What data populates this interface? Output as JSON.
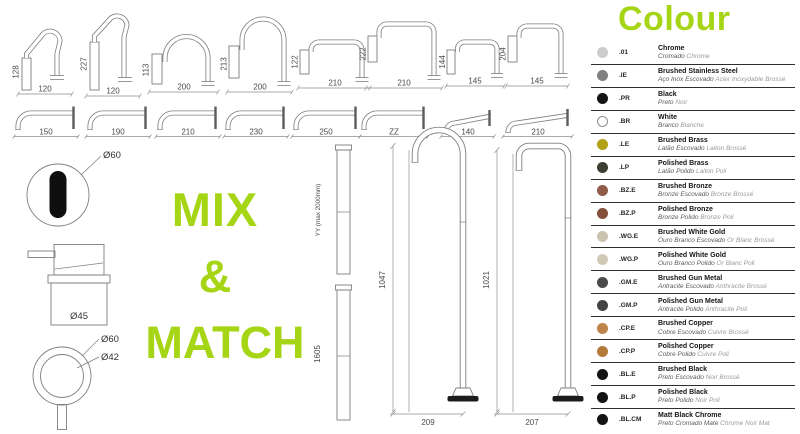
{
  "accent_color": "#a6d515",
  "mix_match": {
    "line1": "MIX",
    "line2": "&",
    "line3": "MATCH"
  },
  "row1_spouts": [
    {
      "h": "128",
      "w": "120"
    },
    {
      "h": "227",
      "w": "120"
    },
    {
      "h": "113",
      "w": "200"
    },
    {
      "h": "213",
      "w": "200"
    },
    {
      "h": "122",
      "w": "210"
    },
    {
      "h": "222",
      "w": "210"
    },
    {
      "h": "144",
      "w": "145"
    },
    {
      "h": "204",
      "w": "145"
    }
  ],
  "row2_spouts": [
    {
      "w": "150"
    },
    {
      "w": "190"
    },
    {
      "w": "210"
    },
    {
      "w": "230"
    },
    {
      "w": "250"
    },
    {
      "w": "ZZ"
    },
    {
      "w": "140"
    },
    {
      "w": "210"
    }
  ],
  "components": {
    "handle_top_diameter": "Ø60",
    "mixer_diameter": "Ø45",
    "ring_outer": "Ø60",
    "ring_inner": "Ø42",
    "riser_adjustable": "YY (max 2000mm)",
    "riser_fixed": "1605"
  },
  "floor_spouts": [
    {
      "height": "1047",
      "base_width": "209"
    },
    {
      "height": "1021",
      "base_width": "207"
    }
  ],
  "colours": {
    "title": "Colour",
    "items": [
      {
        "code": ".01",
        "name": "Chrome",
        "sub_pt": "Cromado",
        "sub_fr": "Chrome",
        "dot": "#cccccc",
        "outlined": false
      },
      {
        "code": ".IE",
        "name": "Brushed Stainless Steel",
        "sub_pt": "Aço Inox Escovado",
        "sub_fr": "Acier Inoxydable Brossé",
        "dot": "#808080",
        "outlined": false
      },
      {
        "code": ".PR",
        "name": "Black",
        "sub_pt": "Preto",
        "sub_fr": "Noir",
        "dot": "#141414",
        "outlined": false
      },
      {
        "code": ".BR",
        "name": "White",
        "sub_pt": "Branco",
        "sub_fr": "Blanche",
        "dot": "#ffffff",
        "outlined": true
      },
      {
        "code": ".LE",
        "name": "Brushed Brass",
        "sub_pt": "Latão Escovado",
        "sub_fr": "Laiton Brossé",
        "dot": "#b2a21a",
        "outlined": false
      },
      {
        "code": ".LP",
        "name": "Polished Brass",
        "sub_pt": "Latão Polido",
        "sub_fr": "Laiton Poli",
        "dot": "#3f3e33",
        "outlined": false
      },
      {
        "code": ".BZ.E",
        "name": "Brushed Bronze",
        "sub_pt": "Bronze Escovado",
        "sub_fr": "Bronze Brossé",
        "dot": "#8e5c48",
        "outlined": false
      },
      {
        "code": ".BZ.P",
        "name": "Polished Bronze",
        "sub_pt": "Bronze Polido",
        "sub_fr": "Bronze Poli",
        "dot": "#84503c",
        "outlined": false
      },
      {
        "code": ".WG.E",
        "name": "Brushed White Gold",
        "sub_pt": "Ouro Branco Escovado",
        "sub_fr": "Or Blanc Brossé",
        "dot": "#cdc4b0",
        "outlined": false
      },
      {
        "code": ".WG.P",
        "name": "Polished White Gold",
        "sub_pt": "Ouro Branco Polido",
        "sub_fr": "Or Blanc Poli",
        "dot": "#d1c8b6",
        "outlined": false
      },
      {
        "code": ".GM.E",
        "name": "Brushed Gun Metal",
        "sub_pt": "Antracite Escovado",
        "sub_fr": "Anthracite Brossé",
        "dot": "#4b4b4b",
        "outlined": false
      },
      {
        "code": ".GM.P",
        "name": "Polished Gun Metal",
        "sub_pt": "Antracite Polido",
        "sub_fr": "Anthracite Poli",
        "dot": "#434343",
        "outlined": false
      },
      {
        "code": ".CP.E",
        "name": "Brushed Copper",
        "sub_pt": "Cobre Escovado",
        "sub_fr": "Cuivre Brossé",
        "dot": "#bd8549",
        "outlined": false
      },
      {
        "code": ".CP.P",
        "name": "Polished Copper",
        "sub_pt": "Cobre Polido",
        "sub_fr": "Cuivre Poli",
        "dot": "#b47a3c",
        "outlined": false
      },
      {
        "code": ".BL.E",
        "name": "Brushed Black",
        "sub_pt": "Preto Escovado",
        "sub_fr": "Noir Brossé",
        "dot": "#131313",
        "outlined": false
      },
      {
        "code": ".BL.P",
        "name": "Polished Black",
        "sub_pt": "Preto Polido",
        "sub_fr": "Noir Poli",
        "dot": "#131313",
        "outlined": false
      },
      {
        "code": ".BL.CM",
        "name": "Matt Black Chrome",
        "sub_pt": "Preto Cromado Mate",
        "sub_fr": "Chrome Noir Mat",
        "dot": "#131313",
        "outlined": false
      }
    ]
  }
}
